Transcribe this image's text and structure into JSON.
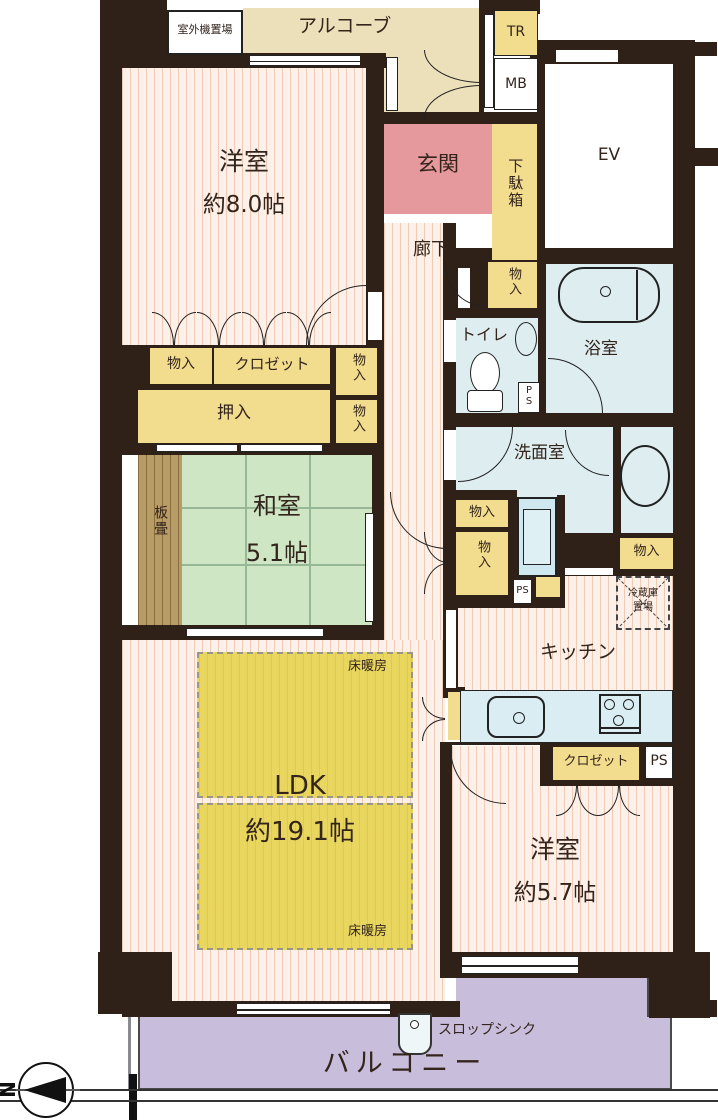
{
  "labels": {
    "outdoor_unit": "室外機置場",
    "alcove": "アルコーブ",
    "tr": "TR",
    "mb": "MB",
    "ev": "EV",
    "genkan": "玄関",
    "shoe_box": "下駄箱",
    "hallway": "廊下",
    "storage": "物入",
    "toilet": "トイレ",
    "ps": "PS",
    "bath": "浴室",
    "washroom": "洗面室",
    "fridge_line1": "冷蔵庫",
    "fridge_line2": "置場",
    "closet": "クロゼット",
    "oshiire": "押入",
    "itatami": "板畳",
    "washitsu": "和室",
    "washitsu_size": "5.1帖",
    "ldk": "LDK",
    "ldk_size": "約19.1帖",
    "floor_heating": "床暖房",
    "kitchen": "キッチン",
    "western": "洋室",
    "western_a_size": "約8.0帖",
    "western_b_size": "約5.7帖",
    "balcony": "バルコニー",
    "slop_sink": "スロップシンク",
    "north": "N"
  },
  "colors": {
    "wall": "#2f2118",
    "floor_stripe_bg": "#fdf0e8",
    "floor_stripe_line": "#ecccb8",
    "alcove_beige": "#ece0ba",
    "storage_yellow": "#f2dc8e",
    "genkan_pink": "#e6999c",
    "wet_area_blue": "#ddedf0",
    "tatami_green": "#cfe6c5",
    "itatami_wood": "#b89c66",
    "floor_heating_yellow": "#e9d65f",
    "balcony_purple": "#c8bedb"
  }
}
